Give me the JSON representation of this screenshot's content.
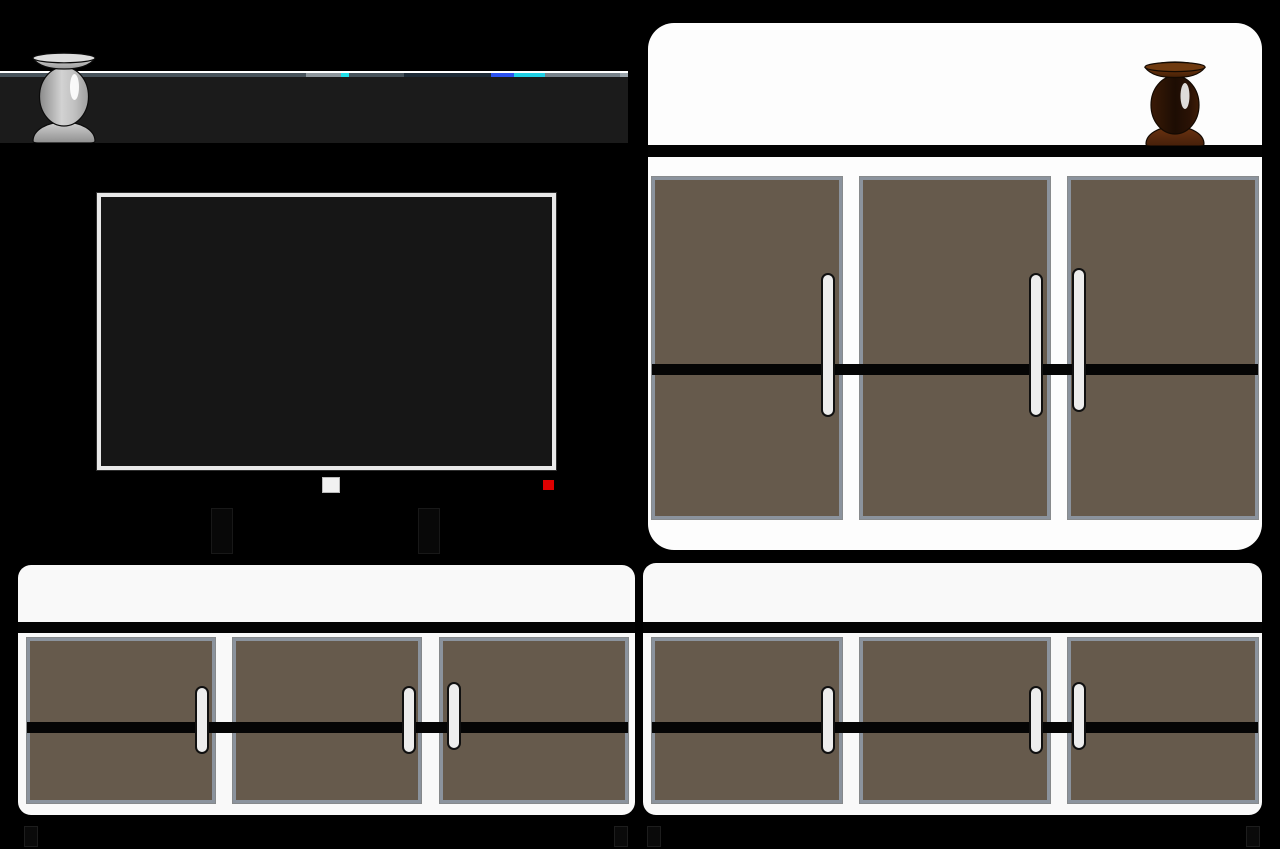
{
  "scene": {
    "description": "Vector illustration of a black living-room media wall: a floating wall shelf holding a silver pedestal vase, a flat-screen TV on legs with a power button and red standby LED, a tall white cabinet topped by a dark brown wooden vase, and two low white cabinets; every cabinet has three brown doors with a black accent stripe and white pill handles, standing on small dark feet."
  },
  "shelf": {
    "edge_accents": [
      "gray",
      "cyan",
      "slate",
      "blue",
      "cyan",
      "gray",
      "light-tip"
    ]
  },
  "tv": {
    "power_led": "on"
  },
  "cabinets": {
    "tall_doors": 3,
    "low_left_doors": 3,
    "low_right_doors": 3,
    "handles_per_cabinet": 3
  },
  "colors": {
    "background": "#000000",
    "shelf_board": "#1b1b1b",
    "shelf_highlight": "#ffffff",
    "shelf_edge": "#47535b",
    "accent_gray": "#8d969c",
    "accent_cyan": "#1fe0e8",
    "accent_slate": "#1d2a36",
    "accent_blue": "#2b52f0",
    "accent_cyan2": "#1fd0e4",
    "accent_gray2": "#77828a",
    "accent_tip": "#9aa4ab",
    "tv_frame": "#e9e9e9",
    "tv_screen": "#161616",
    "tv_button": "#f1f1f1",
    "tv_led_red": "#de0000",
    "tv_leg": "#080808",
    "cabinet_white": "#fdfdfd",
    "cabinet_low_white": "#f9f9f9",
    "band_black": "#030303",
    "door_brown": "#665a4c",
    "door_border": "#8b939d",
    "stripe_black": "#050505",
    "handle_fill": "#ededed",
    "handle_outline": "#101010",
    "foot": "#0a0a0a",
    "silver_light": "#dedede",
    "silver_mid": "#bdbdbd",
    "silver_dark": "#8a8a8a",
    "brown_light": "#8a4312",
    "brown_mid": "#52260a",
    "brown_dark": "#1d0d03"
  }
}
